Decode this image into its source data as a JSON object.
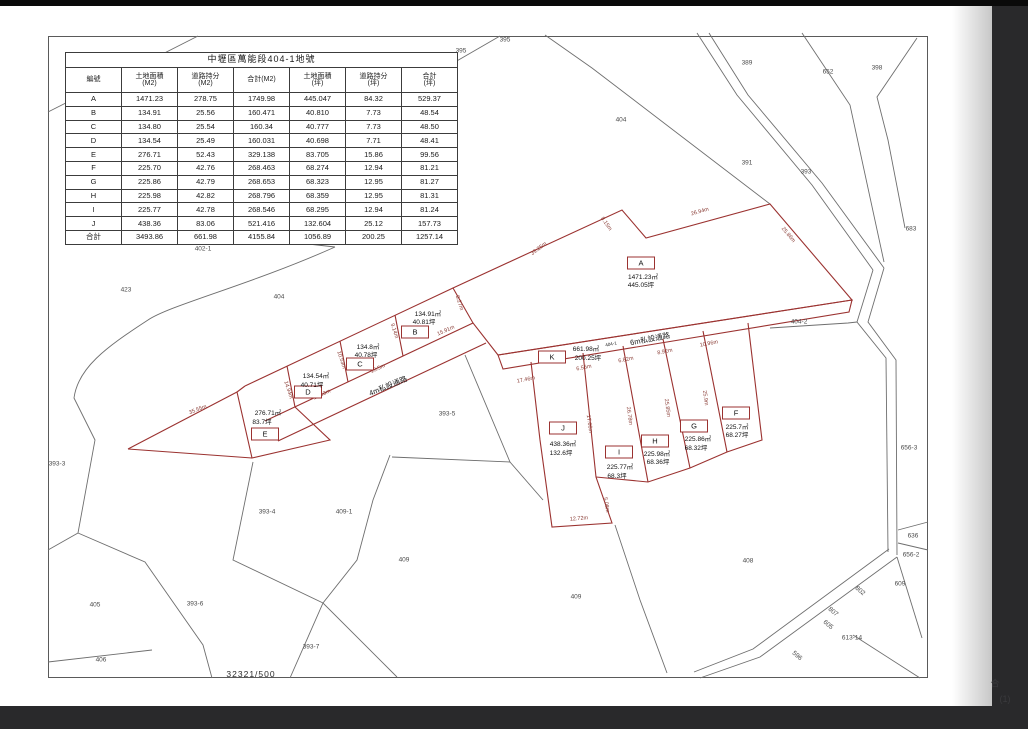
{
  "table": {
    "title": "中壢區萬能段404-1地號",
    "columns": [
      {
        "l1": "編號",
        "l2": ""
      },
      {
        "l1": "土地面積",
        "l2": "(M2)"
      },
      {
        "l1": "道路持分",
        "l2": "(M2)"
      },
      {
        "l1": "合計(M2)",
        "l2": ""
      },
      {
        "l1": "土地面積",
        "l2": "(坪)"
      },
      {
        "l1": "道路持分",
        "l2": "(坪)"
      },
      {
        "l1": "合計",
        "l2": "(坪)"
      }
    ],
    "rows": [
      [
        "A",
        "1471.23",
        "278.75",
        "1749.98",
        "445.047",
        "84.32",
        "529.37"
      ],
      [
        "B",
        "134.91",
        "25.56",
        "160.471",
        "40.810",
        "7.73",
        "48.54"
      ],
      [
        "C",
        "134.80",
        "25.54",
        "160.34",
        "40.777",
        "7.73",
        "48.50"
      ],
      [
        "D",
        "134.54",
        "25.49",
        "160.031",
        "40.698",
        "7.71",
        "48.41"
      ],
      [
        "E",
        "276.71",
        "52.43",
        "329.138",
        "83.705",
        "15.86",
        "99.56"
      ],
      [
        "F",
        "225.70",
        "42.76",
        "268.463",
        "68.274",
        "12.94",
        "81.21"
      ],
      [
        "G",
        "225.86",
        "42.79",
        "268.653",
        "68.323",
        "12.95",
        "81.27"
      ],
      [
        "H",
        "225.98",
        "42.82",
        "268.796",
        "68.359",
        "12.95",
        "81.31"
      ],
      [
        "I",
        "225.77",
        "42.78",
        "268.546",
        "68.295",
        "12.94",
        "81.24"
      ],
      [
        "J",
        "438.36",
        "83.06",
        "521.416",
        "132.604",
        "25.12",
        "157.73"
      ],
      [
        "合計",
        "3493.86",
        "661.98",
        "4155.84",
        "1056.89",
        "200.25",
        "1257.14"
      ]
    ]
  },
  "map": {
    "scale_text": "32321/500",
    "parcels": [
      {
        "id": "A",
        "m2": "1471.23㎡",
        "ping": "445.05坪",
        "bx": 641,
        "by": 263,
        "mx": 643,
        "my": 276,
        "px": 641,
        "py": 284
      },
      {
        "id": "B",
        "m2": "134.91㎡",
        "ping": "40.81坪",
        "bx": 415,
        "by": 332,
        "mx": 428,
        "my": 313,
        "px": 424,
        "py": 321
      },
      {
        "id": "C",
        "m2": "134.8㎡",
        "ping": "40.78坪",
        "bx": 360,
        "by": 364,
        "mx": 368,
        "my": 346,
        "px": 366,
        "py": 354
      },
      {
        "id": "D",
        "m2": "134.54㎡",
        "ping": "40.71坪",
        "bx": 308,
        "by": 392,
        "mx": 316,
        "my": 375,
        "px": 312,
        "py": 384
      },
      {
        "id": "E",
        "m2": "276.71㎡",
        "ping": "83.7坪",
        "bx": 265,
        "by": 434,
        "mx": 268,
        "my": 412,
        "px": 262,
        "py": 421
      },
      {
        "id": "K",
        "m2": "661.98㎡",
        "ping": "200.25坪",
        "bx": 552,
        "by": 357,
        "mx": 586,
        "my": 348,
        "px": 588,
        "py": 357
      },
      {
        "id": "J",
        "m2": "438.36㎡",
        "ping": "132.6坪",
        "bx": 563,
        "by": 428,
        "mx": 563,
        "my": 443,
        "px": 561,
        "py": 452
      },
      {
        "id": "I",
        "m2": "225.77㎡",
        "ping": "68.3坪",
        "bx": 619,
        "by": 452,
        "mx": 620,
        "my": 466,
        "px": 617,
        "py": 475
      },
      {
        "id": "H",
        "m2": "225.98㎡",
        "ping": "68.36坪",
        "bx": 655,
        "by": 441,
        "mx": 657,
        "my": 453,
        "px": 658,
        "py": 461
      },
      {
        "id": "G",
        "m2": "225.86㎡",
        "ping": "68.32坪",
        "bx": 694,
        "by": 426,
        "mx": 698,
        "my": 438,
        "px": 696,
        "py": 447
      },
      {
        "id": "F",
        "m2": "225.7㎡",
        "ping": "68.27坪",
        "bx": 736,
        "by": 413,
        "mx": 737,
        "my": 426,
        "px": 737,
        "py": 434
      }
    ],
    "roads": [
      {
        "text": "6m私設通路",
        "x": 650,
        "y": 339,
        "rot": -11,
        "size": 7.5
      },
      {
        "text": "404-1",
        "x": 611,
        "y": 344,
        "rot": -11,
        "size": 4.5
      },
      {
        "text": "4m私設通路",
        "x": 388,
        "y": 386,
        "rot": -22,
        "size": 7.5
      }
    ],
    "measurements": [
      {
        "t": "39.25m",
        "x": 539,
        "y": 249,
        "r": -37
      },
      {
        "t": "8.15m",
        "x": 606,
        "y": 224,
        "r": 55
      },
      {
        "t": "26.94m",
        "x": 700,
        "y": 212,
        "r": -16
      },
      {
        "t": "25.86m",
        "x": 788,
        "y": 235,
        "r": 50
      },
      {
        "t": "8.27m",
        "x": 459,
        "y": 303,
        "r": 72
      },
      {
        "t": "15.91m",
        "x": 446,
        "y": 331,
        "r": -24
      },
      {
        "t": "9.14m",
        "x": 394,
        "y": 331,
        "r": 72
      },
      {
        "t": "13.5m",
        "x": 378,
        "y": 369,
        "r": -24
      },
      {
        "t": "10.53m",
        "x": 341,
        "y": 360,
        "r": 72
      },
      {
        "t": "12.53m",
        "x": 322,
        "y": 395,
        "r": -24
      },
      {
        "t": "14.94m",
        "x": 288,
        "y": 390,
        "r": 72
      },
      {
        "t": "35.55m",
        "x": 198,
        "y": 410,
        "r": -21
      },
      {
        "t": "17.46m",
        "x": 526,
        "y": 380,
        "r": -11
      },
      {
        "t": "6.55m",
        "x": 584,
        "y": 368,
        "r": -11
      },
      {
        "t": "6.82m",
        "x": 626,
        "y": 360,
        "r": -11
      },
      {
        "t": "8.92m",
        "x": 665,
        "y": 352,
        "r": -11
      },
      {
        "t": "10.96m",
        "x": 709,
        "y": 344,
        "r": -11
      },
      {
        "t": "17.66m",
        "x": 589,
        "y": 424,
        "r": 82
      },
      {
        "t": "26.78m",
        "x": 629,
        "y": 416,
        "r": 82
      },
      {
        "t": "25.85m",
        "x": 667,
        "y": 408,
        "r": 82
      },
      {
        "t": "25.9m",
        "x": 705,
        "y": 398,
        "r": 82
      },
      {
        "t": "12.72m",
        "x": 579,
        "y": 519,
        "r": -5
      },
      {
        "t": "5.08m",
        "x": 606,
        "y": 505,
        "r": 80
      }
    ],
    "lots": [
      {
        "t": "395",
        "x": 505,
        "y": 40
      },
      {
        "t": "395",
        "x": 461,
        "y": 51
      },
      {
        "t": "389",
        "x": 747,
        "y": 63
      },
      {
        "t": "652",
        "x": 828,
        "y": 72
      },
      {
        "t": "398",
        "x": 877,
        "y": 68
      },
      {
        "t": "404",
        "x": 621,
        "y": 120
      },
      {
        "t": "391",
        "x": 747,
        "y": 163
      },
      {
        "t": "393",
        "x": 806,
        "y": 172
      },
      {
        "t": "683",
        "x": 911,
        "y": 229
      },
      {
        "t": "402-1",
        "x": 203,
        "y": 249
      },
      {
        "t": "423",
        "x": 126,
        "y": 290
      },
      {
        "t": "404",
        "x": 279,
        "y": 297
      },
      {
        "t": "404-2",
        "x": 799,
        "y": 322
      },
      {
        "t": "393-5",
        "x": 447,
        "y": 414
      },
      {
        "t": "393-3",
        "x": 57,
        "y": 464
      },
      {
        "t": "393-4",
        "x": 267,
        "y": 512
      },
      {
        "t": "409-1",
        "x": 344,
        "y": 512
      },
      {
        "t": "409",
        "x": 404,
        "y": 560
      },
      {
        "t": "409",
        "x": 576,
        "y": 597
      },
      {
        "t": "408",
        "x": 748,
        "y": 561
      },
      {
        "t": "405",
        "x": 95,
        "y": 605
      },
      {
        "t": "393-6",
        "x": 195,
        "y": 604
      },
      {
        "t": "406",
        "x": 101,
        "y": 660
      },
      {
        "t": "393-7",
        "x": 311,
        "y": 647
      },
      {
        "t": "656-3",
        "x": 909,
        "y": 448
      },
      {
        "t": "636",
        "x": 913,
        "y": 536
      },
      {
        "t": "656-2",
        "x": 911,
        "y": 555
      },
      {
        "t": "609",
        "x": 900,
        "y": 584
      },
      {
        "t": "613-14",
        "x": 852,
        "y": 638
      },
      {
        "t": "802",
        "x": 860,
        "y": 591,
        "r": 40
      },
      {
        "t": "807",
        "x": 833,
        "y": 612,
        "r": 40
      },
      {
        "t": "605",
        "x": 828,
        "y": 625,
        "r": 40
      },
      {
        "t": "596",
        "x": 797,
        "y": 656,
        "r": 40
      }
    ],
    "ghosts": [
      {
        "t": "合",
        "x": 995,
        "y": 683
      },
      {
        "t": "(1)",
        "x": 1005,
        "y": 699
      }
    ]
  }
}
